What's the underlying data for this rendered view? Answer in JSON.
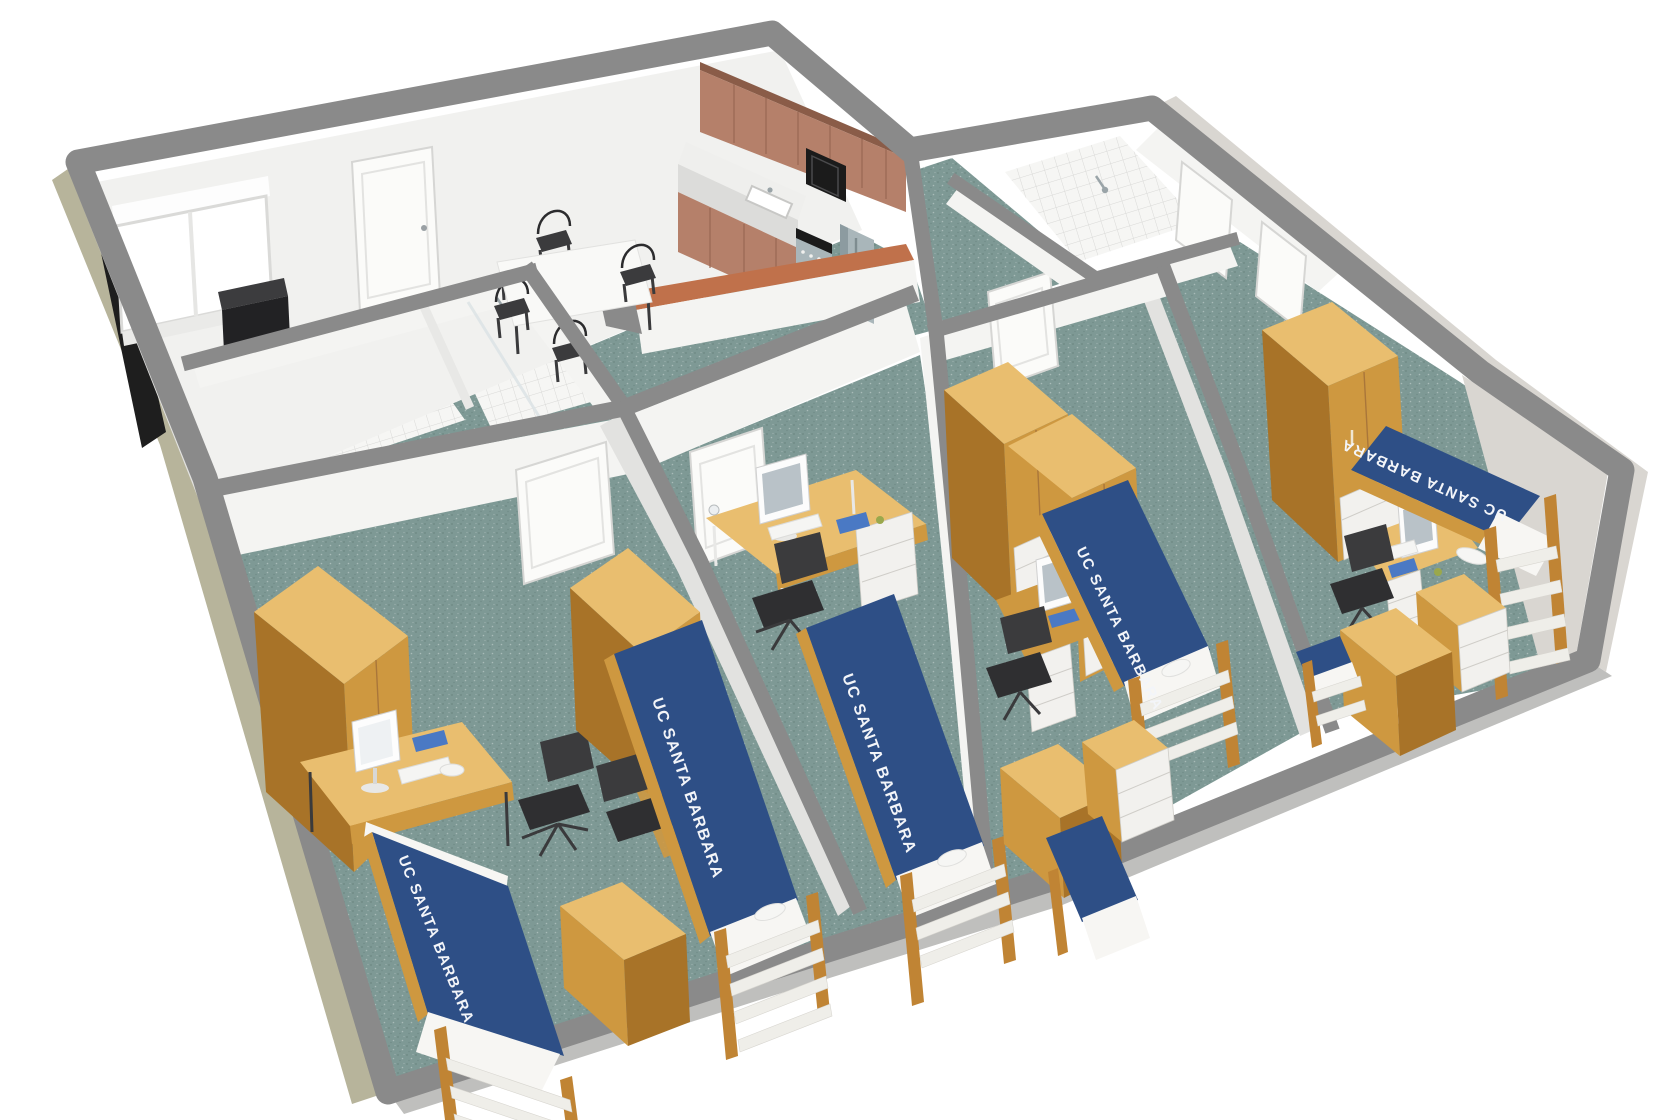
{
  "scene": {
    "description": "3D cutaway floor plan render of a furnished student apartment",
    "bed_count": 5,
    "bedroom_count": 4,
    "bathroom_count": 2
  },
  "labels": {
    "bed_spread": "UC SANTA BARBARA"
  },
  "colors": {
    "wallTop": "#8a8a8a",
    "wallFace": "#f4f4f2",
    "northFace": "#f1f1ef",
    "wallShade": "#e2e2e0",
    "exteriorKhaki": "#b7b49b",
    "exteriorShadow": "#1e1e1e",
    "southFace": "#bfbfbd",
    "eastFace": "#d9d6d1",
    "carpet": "#7e9995",
    "carpetSpeckDark": "#5e7975",
    "tile": "#f6f6f4",
    "tileLine": "#d9d9d7",
    "cabinet": "#b5806a",
    "cabinetDark": "#9a6753",
    "cabinetTop": "#8a5c48",
    "counter": "#efefed",
    "counterFace": "#dcdcda",
    "barTop": "#c0714b",
    "steel": "#a9b6ba",
    "steelDark": "#8c9ba0",
    "applianceBlack": "#1b1b1b",
    "wood": "#ce9840",
    "woodLight": "#e9be6f",
    "woodDark": "#a87328",
    "drawerWhite": "#f2f1ee",
    "bedBlue": "#2e4f86",
    "bedBlueDark": "#24406e",
    "linen": "#f7f6f3",
    "chair": "#3b3b3d",
    "doorLine": "#d6d6d4",
    "paperBlue": "#4a79c4",
    "labelText": "#f3f5f9",
    "glass": "#dde4e6"
  }
}
